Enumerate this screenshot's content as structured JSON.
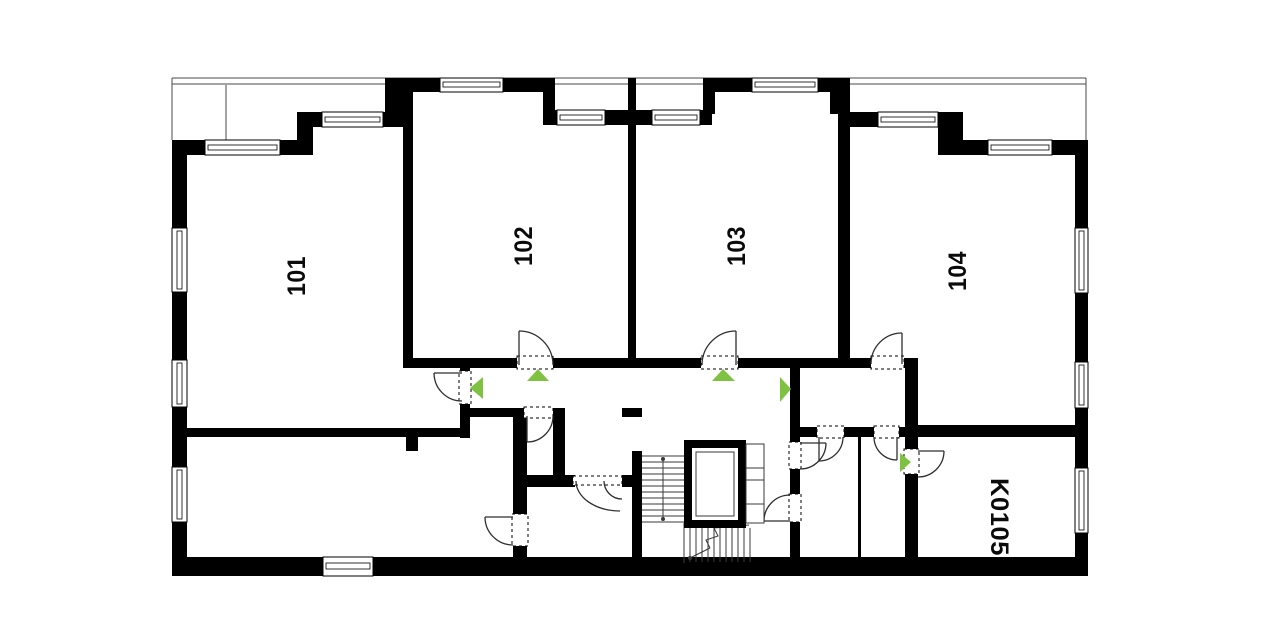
{
  "floor_plan": {
    "colors": {
      "wall": "#000000",
      "thin_line": "#3a3a3a",
      "arrow_green": "#7fc241",
      "background": "#ffffff"
    },
    "rooms": [
      {
        "id": "room-101",
        "label": "101"
      },
      {
        "id": "room-102",
        "label": "102"
      },
      {
        "id": "room-103",
        "label": "103"
      },
      {
        "id": "room-104",
        "label": "104"
      },
      {
        "id": "room-k0105",
        "label": "K0105"
      }
    ],
    "entrance_arrows": [
      {
        "room": "101",
        "direction": "left"
      },
      {
        "room": "102",
        "direction": "up"
      },
      {
        "room": "103",
        "direction": "up"
      },
      {
        "room": "104",
        "direction": "right"
      },
      {
        "room": "K0105",
        "direction": "right"
      }
    ]
  }
}
